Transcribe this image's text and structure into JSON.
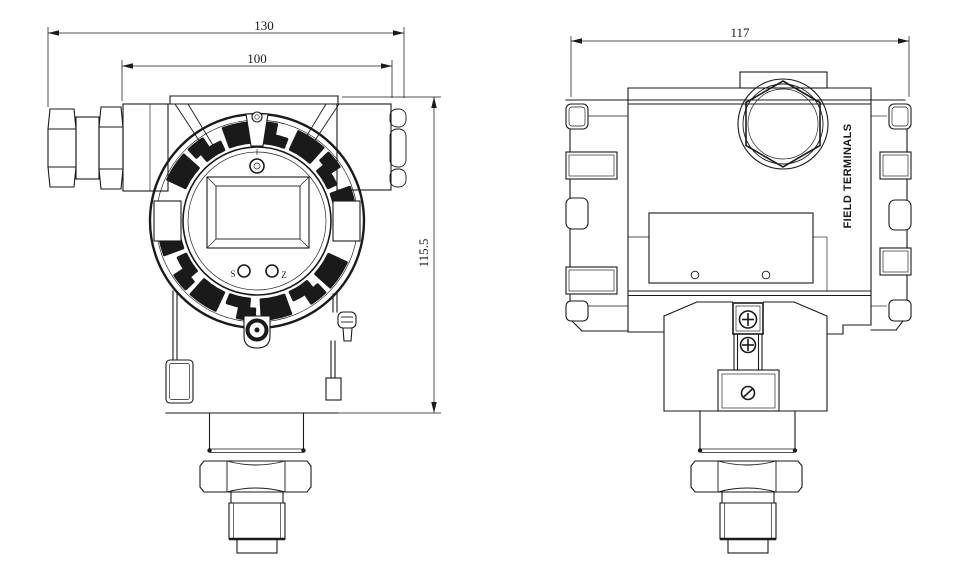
{
  "drawing": {
    "paper_color": "#ffffff",
    "ink_color": "#1a1a1a",
    "front_view": {
      "dim_overall_width": "130",
      "dim_body_width": "100",
      "dim_body_height": "115.5",
      "display_button_left": "S",
      "display_button_right": "Z"
    },
    "side_view": {
      "dim_overall_width": "117",
      "terminal_side_label": "FIELD TERMINALS"
    }
  }
}
